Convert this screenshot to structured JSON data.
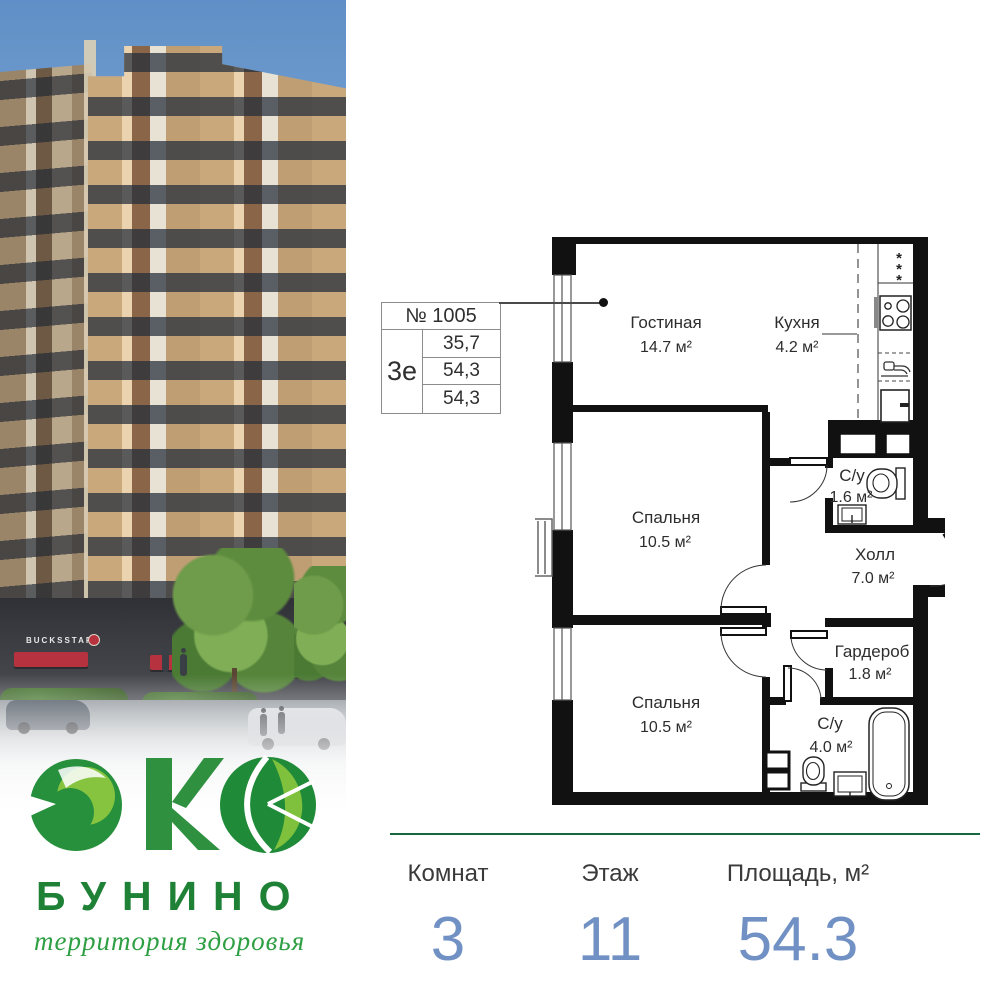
{
  "brand": {
    "logo_word": "ЭКО",
    "name": "БУНИНО",
    "tagline": "территория здоровья",
    "storefront_sign": "BUCKSSTAR"
  },
  "apartment_card": {
    "number": "№ 1005",
    "type": "3е",
    "areas": [
      "35,7",
      "54,3",
      "54,3"
    ]
  },
  "floor_plan": {
    "vent_symbol": "*",
    "rooms": [
      {
        "name": "Гостиная",
        "area": "14.7 м²"
      },
      {
        "name": "Кухня",
        "area": "4.2 м²"
      },
      {
        "name": "Спальня",
        "area": "10.5 м²"
      },
      {
        "name": "Спальня",
        "area": "10.5 м²"
      },
      {
        "name": "С/у",
        "area": "1.6 м²"
      },
      {
        "name": "Холл",
        "area": "7.0 м²"
      },
      {
        "name": "Гардероб",
        "area": "1.8 м²"
      },
      {
        "name": "С/у",
        "area": "4.0 м²"
      }
    ]
  },
  "summary": {
    "items": [
      {
        "label": "Комнат",
        "value": "3"
      },
      {
        "label": "Этаж",
        "value": "11"
      },
      {
        "label": "Площадь, м²",
        "value": "54.3"
      }
    ]
  },
  "colors": {
    "accent_green": "#15673e",
    "value_blue": "#7191c4",
    "awning_red": "#b5323e",
    "wall_black": "#111111"
  }
}
